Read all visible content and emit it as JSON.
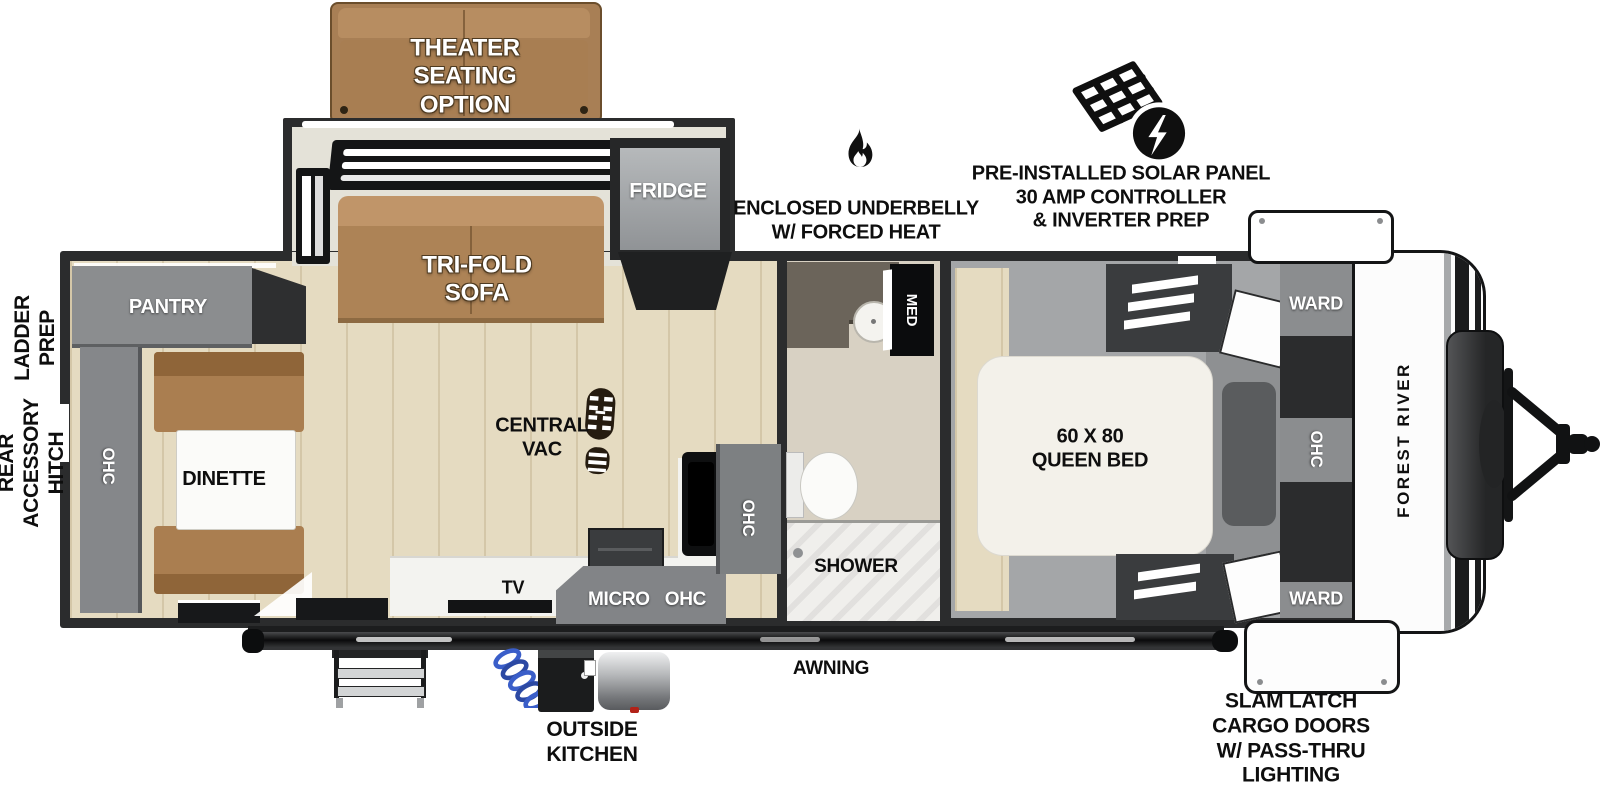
{
  "labels": {
    "theater": "THEATER\nSEATING\nOPTION",
    "tri_fold_sofa": "TRI-FOLD\nSOFA",
    "fridge": "FRIDGE",
    "pantry": "PANTRY",
    "rear_ohc": "OHC",
    "dinette": "DINETTE",
    "central_vac": "CENTRAL\nVAC",
    "tv": "TV",
    "micro_ohc": "MICRO   OHC",
    "kitchen_ohc": "OHC",
    "med": "MED",
    "shower": "SHOWER",
    "queen_bed": "60 X 80\nQUEEN BED",
    "ward_top": "WARD",
    "bedroom_ohc": "OHC",
    "ward_bottom": "WARD",
    "brand": "FOREST RIVER",
    "ladder_prep": "LADDER\nPREP",
    "rear_accessory_hitch": "REAR\nACCESSORY\nHITCH",
    "enclosed_underbelly": "ENCLOSED UNDERBELLY\nW/ FORCED HEAT",
    "solar_prep": "PRE-INSTALLED SOLAR PANEL\n30 AMP CONTROLLER\n& INVERTER PREP",
    "awning": "AWNING",
    "outside_kitchen": "OUTSIDE\nKITCHEN",
    "cargo_doors": "SLAM LATCH\nCARGO DOORS\nW/ PASS-THRU\nLIGHTING"
  },
  "colors": {
    "wall": "#2b2c2d",
    "wood_floor": "#e5dbc1",
    "slide_floor": "#e4e2d8",
    "cabinet_gray": "#8b8d8f",
    "sofa_tan": "#ad8356",
    "bed_white": "#f3f1ea",
    "bedroom_carpet": "#a4a6a8",
    "bath_floor": "#d8d1c3",
    "hose_blue": "#3a5ec9"
  }
}
